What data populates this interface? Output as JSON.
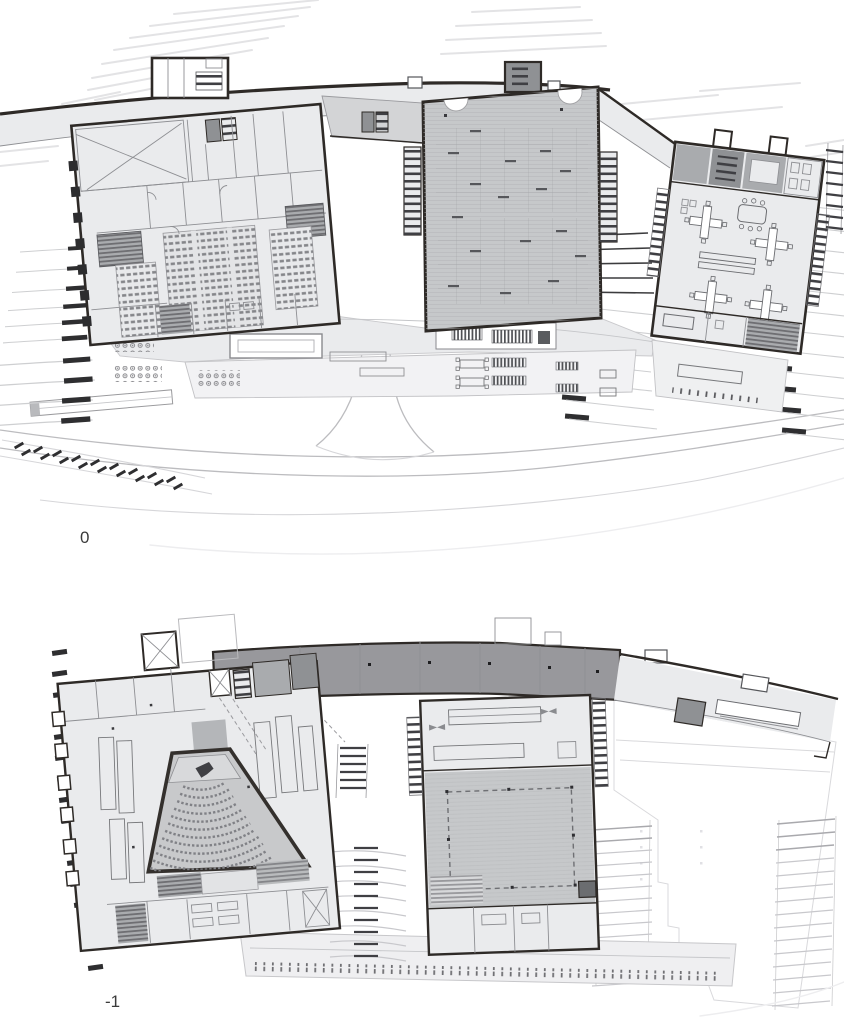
{
  "figure": {
    "kind": "architectural-floor-plans",
    "plans": [
      {
        "id": "level-0",
        "label": "0"
      },
      {
        "id": "level-minus-1",
        "label": "-1"
      }
    ]
  },
  "palette": {
    "background": "#ffffff",
    "wall": "#2e2a27",
    "line_thin": "#8e8f93",
    "contour": "#e3e3e5",
    "road": "#bcbcbf",
    "room_light": "#eaebed",
    "room_mid": "#c6c8ca",
    "room_gray": "#a9abae",
    "room_dark": "#8f9194",
    "band_dark": "#98989c",
    "ghost_fill": "#f8f8f9",
    "ghost_line": "#d9d9dc",
    "step_dark": "#2e2e30",
    "seat": "#85868a",
    "furniture": "#6b6c70",
    "label": "#3b3b3b"
  }
}
